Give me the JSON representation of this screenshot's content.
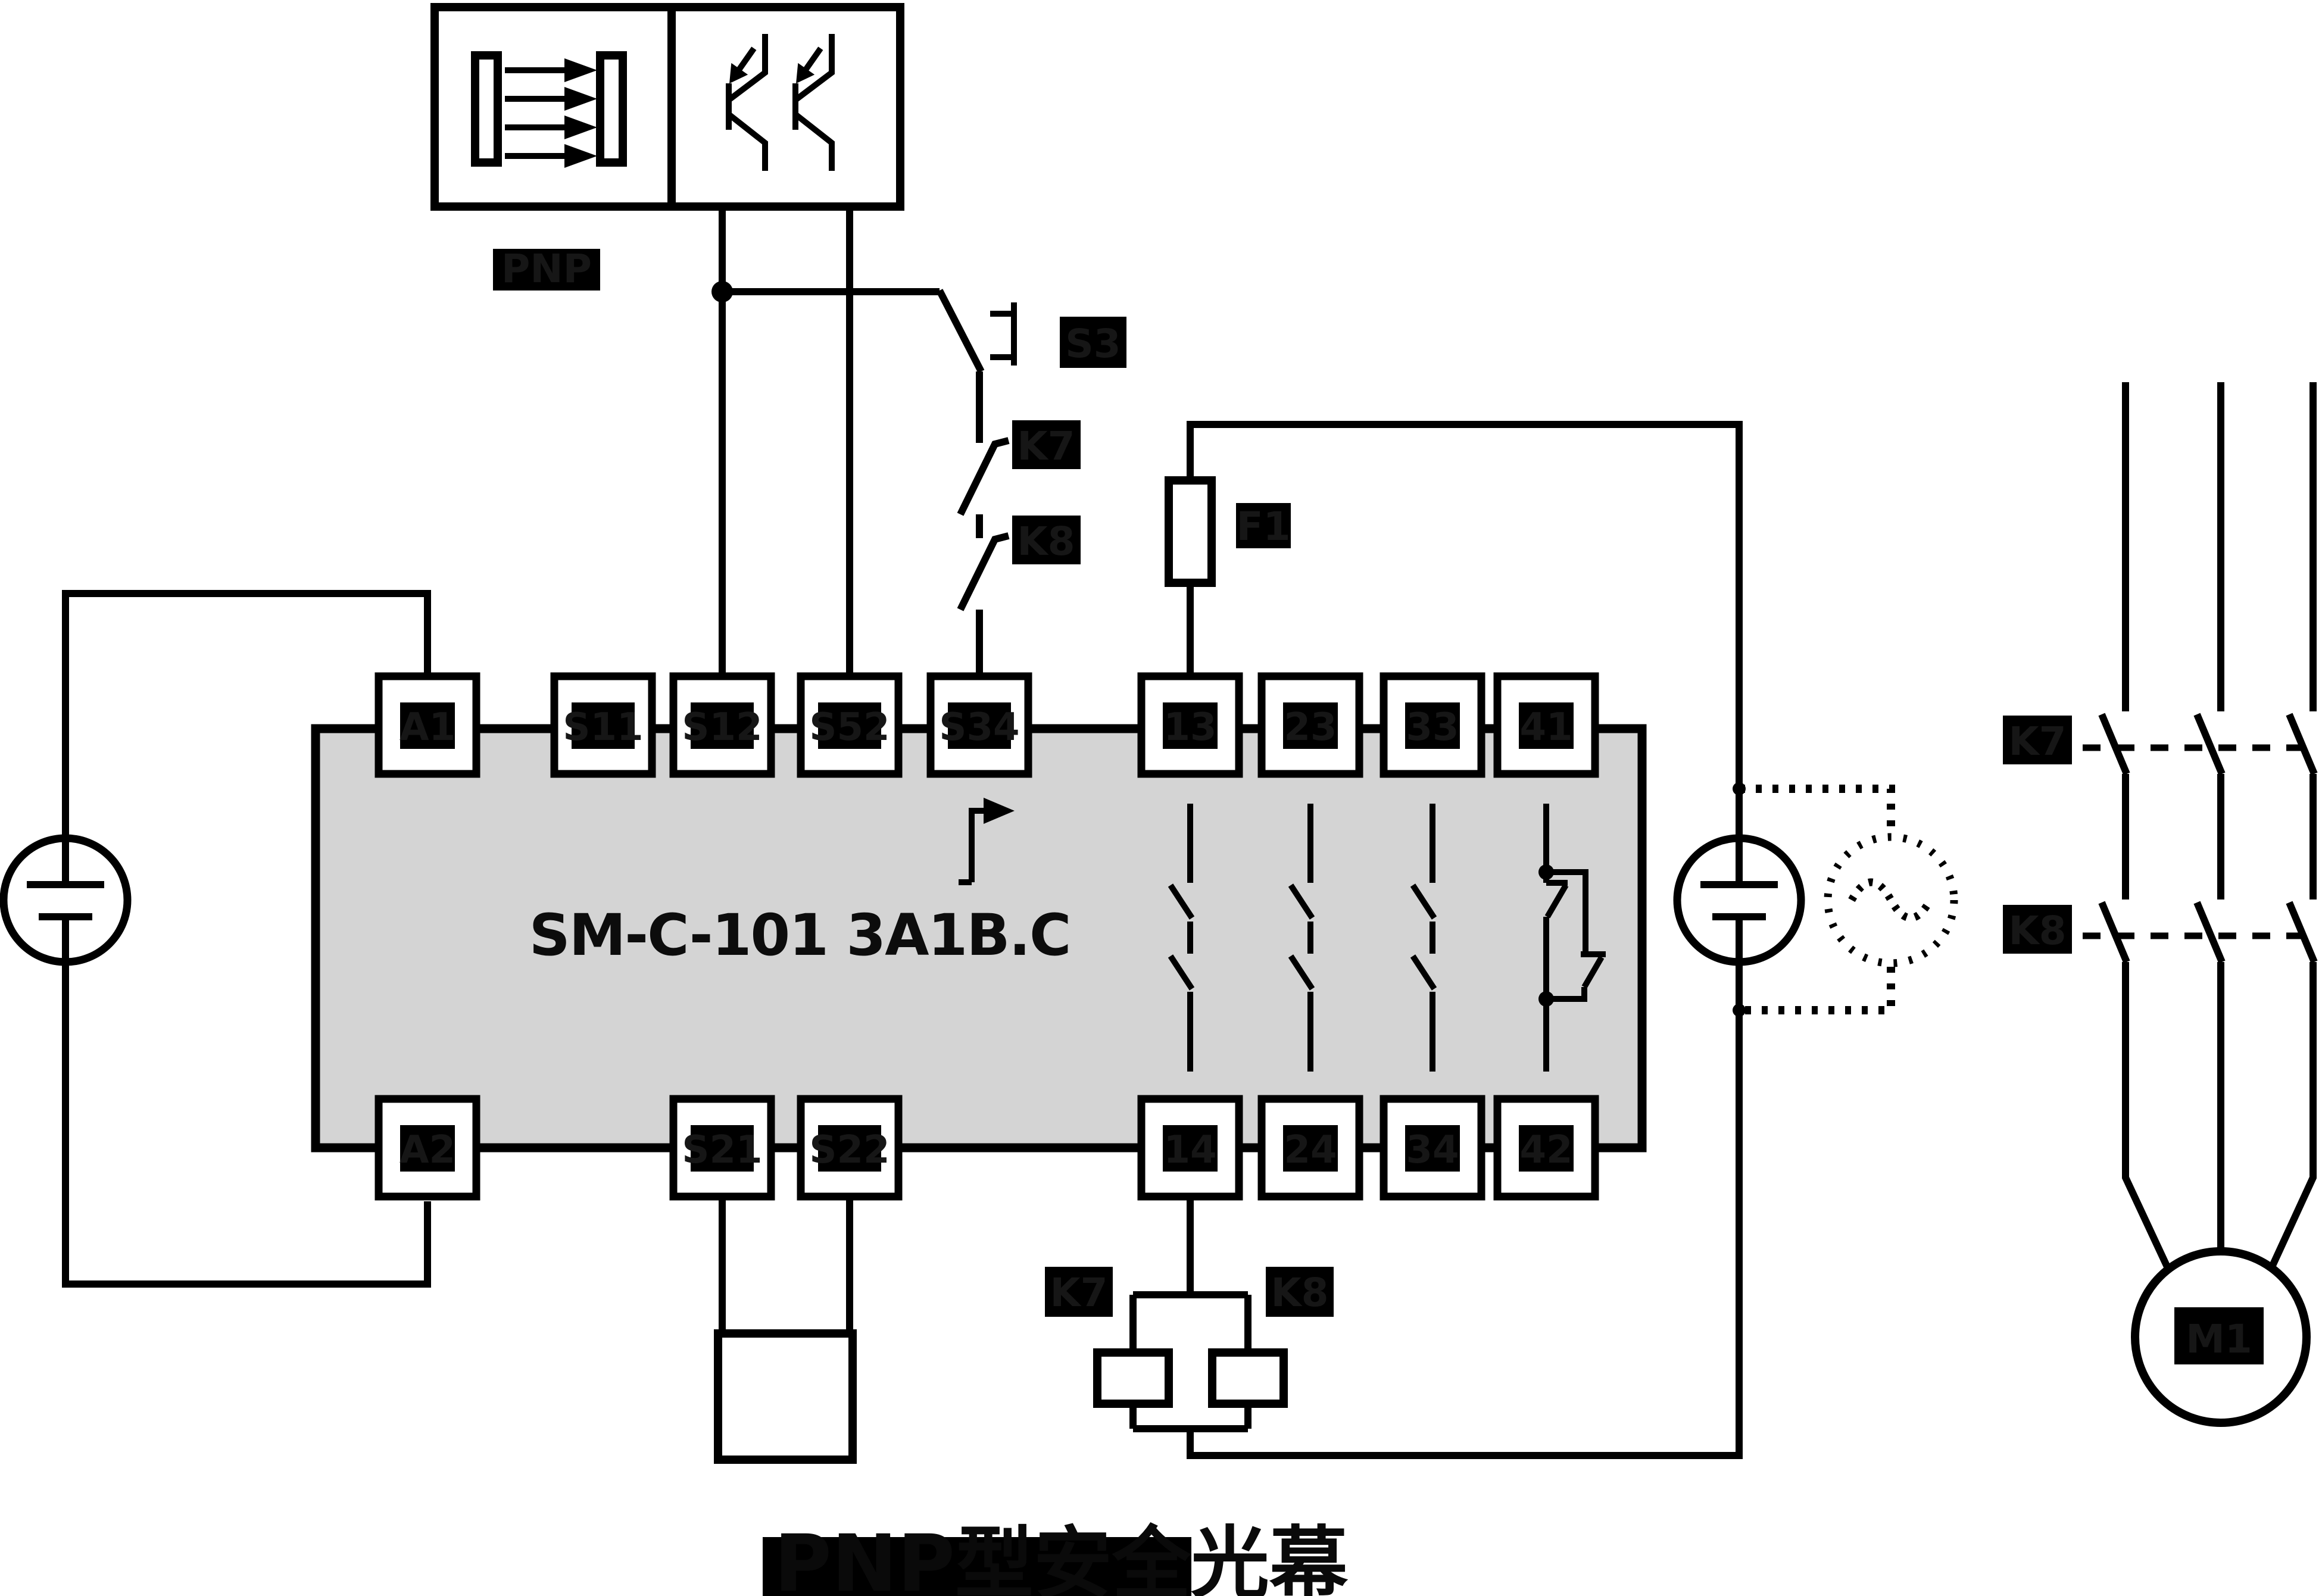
{
  "module": {
    "title": "SM-C-101 3A1B.C"
  },
  "sensor": {
    "type_label": "PNP",
    "caption": "PNP型安全光幕"
  },
  "terminals": {
    "top": [
      "A1",
      "S11",
      "S12",
      "S52",
      "S34",
      "13",
      "23",
      "33",
      "41"
    ],
    "bottom": [
      "A2",
      "S21",
      "S22",
      "14",
      "24",
      "34",
      "42"
    ]
  },
  "components": {
    "reset_button": "S3",
    "feedback_contact_k7": "K7",
    "feedback_contact_k8": "K8",
    "fuse": "F1",
    "coil_k7": "K7",
    "coil_k8": "K8",
    "contactor_k7": "K7",
    "contactor_k8": "K8",
    "motor": "M1"
  },
  "colors": {
    "line": "#000000",
    "module_fill": "#d4d4d4",
    "background": "#ffffff"
  }
}
